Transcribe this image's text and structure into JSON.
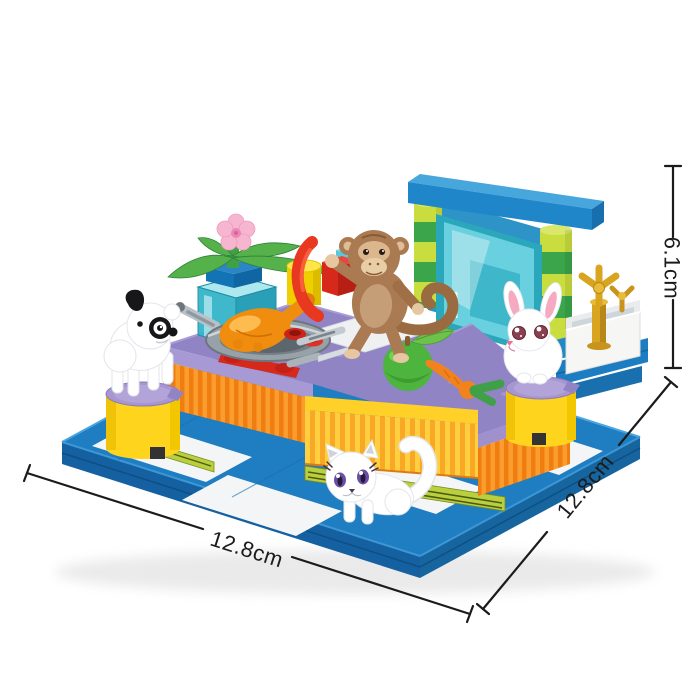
{
  "annotations": {
    "width_label": "12.8cm",
    "depth_label": "12.8cm",
    "height_label": "6.1cm"
  },
  "scene": {
    "figures": [
      "dog",
      "cat",
      "rabbit",
      "monkey"
    ],
    "objects": [
      "baseplate",
      "kitchen-counter",
      "stove-pan",
      "roast-chicken",
      "flower-pot",
      "glass-tank",
      "glass-door",
      "pillars",
      "apple",
      "carrot",
      "sausage",
      "knife",
      "jar",
      "gold-faucet",
      "sink-basin",
      "stool-left",
      "stool-right"
    ]
  },
  "palette": {
    "baseplate_blue": "#1f7dc2",
    "counter_purple": "#9184c5",
    "counter_orange": "#f68b1f",
    "accent_yellow": "#ffd028",
    "glass_teal": "#6fd4e2",
    "pillar_lime": "#c9dd3e",
    "pillar_green": "#3aa54b",
    "stool_yellow": "#ffd41c",
    "gold": "#d9a41f",
    "dimension_line": "#1b1b1b"
  }
}
